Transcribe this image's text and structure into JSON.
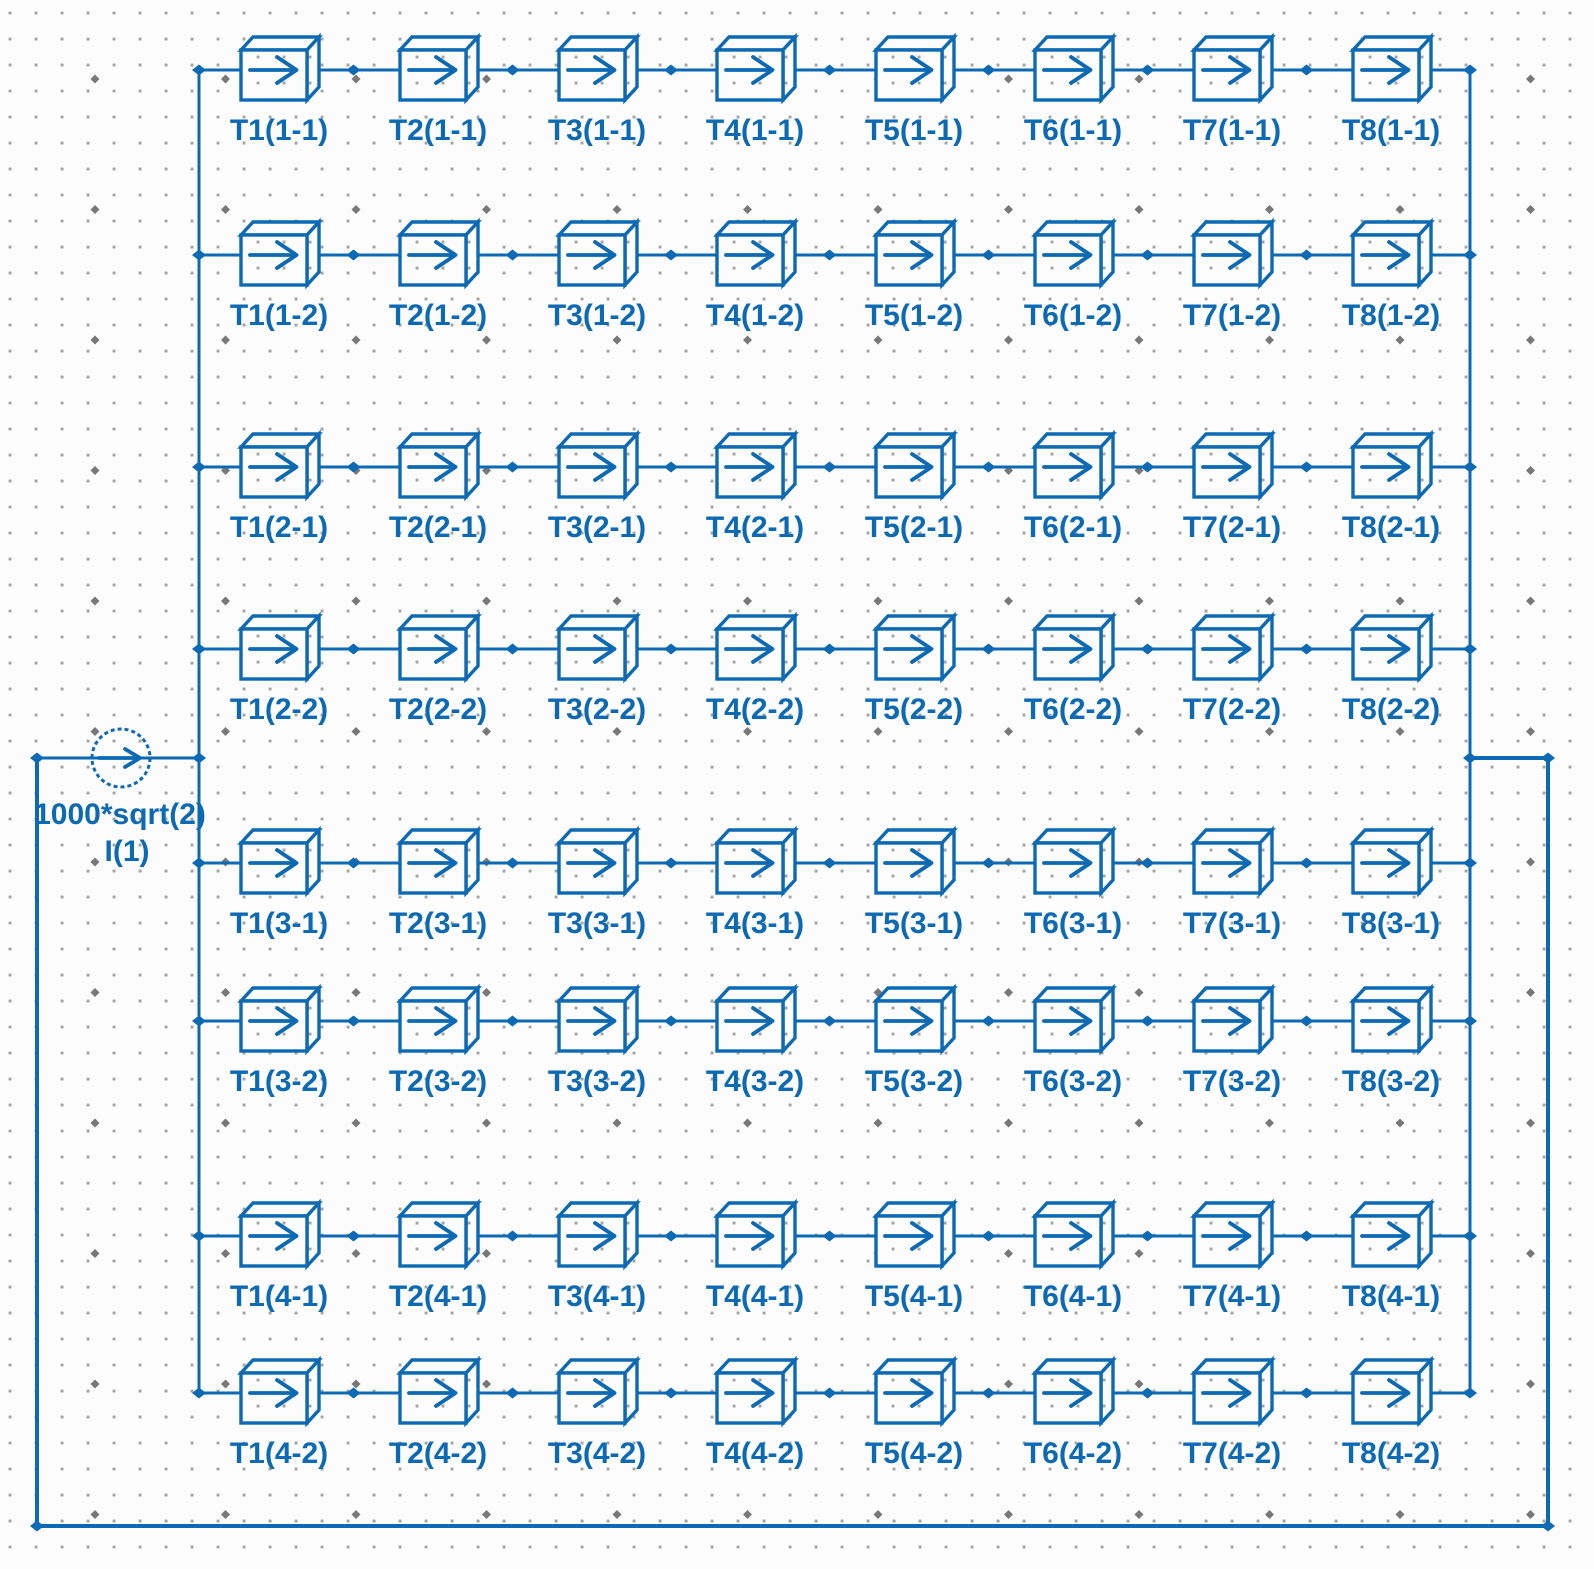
{
  "source": {
    "value_label": "1000*sqrt(2)",
    "name_label": "I(1)"
  },
  "block_rows": [
    {
      "blocks": [
        "T1(1-1)",
        "T2(1-1)",
        "T3(1-1)",
        "T4(1-1)",
        "T5(1-1)",
        "T6(1-1)",
        "T7(1-1)",
        "T8(1-1)"
      ]
    },
    {
      "blocks": [
        "T1(1-2)",
        "T2(1-2)",
        "T3(1-2)",
        "T4(1-2)",
        "T5(1-2)",
        "T6(1-2)",
        "T7(1-2)",
        "T8(1-2)"
      ]
    },
    {
      "blocks": [
        "T1(2-1)",
        "T2(2-1)",
        "T3(2-1)",
        "T4(2-1)",
        "T5(2-1)",
        "T6(2-1)",
        "T7(2-1)",
        "T8(2-1)"
      ]
    },
    {
      "blocks": [
        "T1(2-2)",
        "T2(2-2)",
        "T3(2-2)",
        "T4(2-2)",
        "T5(2-2)",
        "T6(2-2)",
        "T7(2-2)",
        "T8(2-2)"
      ]
    },
    {
      "blocks": [
        "T1(3-1)",
        "T2(3-1)",
        "T3(3-1)",
        "T4(3-1)",
        "T5(3-1)",
        "T6(3-1)",
        "T7(3-1)",
        "T8(3-1)"
      ]
    },
    {
      "blocks": [
        "T1(3-2)",
        "T2(3-2)",
        "T3(3-2)",
        "T4(3-2)",
        "T5(3-2)",
        "T6(3-2)",
        "T7(3-2)",
        "T8(3-2)"
      ]
    },
    {
      "blocks": [
        "T1(4-1)",
        "T2(4-1)",
        "T3(4-1)",
        "T4(4-1)",
        "T5(4-1)",
        "T6(4-1)",
        "T7(4-1)",
        "T8(4-1)"
      ]
    },
    {
      "blocks": [
        "T1(4-2)",
        "T2(4-2)",
        "T3(4-2)",
        "T4(4-2)",
        "T5(4-2)",
        "T6(4-2)",
        "T7(4-2)",
        "T8(4-2)"
      ]
    }
  ],
  "icons": {
    "block_symbol": "right-arrow-box",
    "source_symbol": "right-arrow-circle"
  },
  "colors": {
    "wire": "#0c69b4",
    "label_text": "#0c69b4",
    "grid_dot": "#a3a3a3",
    "grid_bold_dot": "#787878",
    "background": "#fcfcfc"
  }
}
